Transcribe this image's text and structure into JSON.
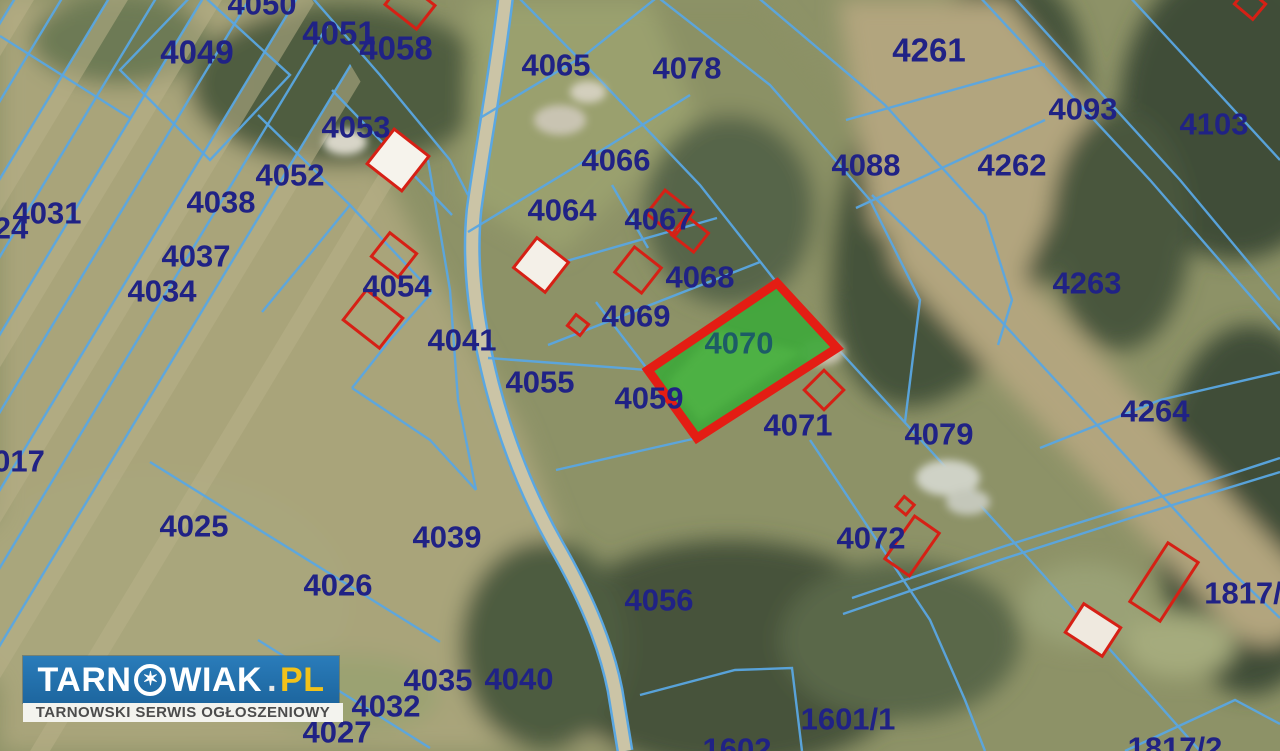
{
  "map": {
    "type": "cadastral-aerial",
    "highlighted_parcel": "4070",
    "highlight_fill": "#3fa83b",
    "highlight_border": "#e41d14",
    "boundary_color": "#5aa7e2",
    "label_color": "#202285",
    "highlight_label_color": "#1d5c66",
    "building_outline_color": "#d62015",
    "parcel_labels": [
      {
        "text": "4050",
        "x": 262,
        "y": 4
      },
      {
        "text": "4049",
        "x": 197,
        "y": 52,
        "size": 33
      },
      {
        "text": "4051",
        "x": 339,
        "y": 33,
        "size": 33
      },
      {
        "text": "4058",
        "x": 396,
        "y": 48,
        "size": 33
      },
      {
        "text": "4053",
        "x": 356,
        "y": 127
      },
      {
        "text": "4052",
        "x": 290,
        "y": 175
      },
      {
        "text": "4038",
        "x": 221,
        "y": 202
      },
      {
        "text": "4031",
        "x": 47,
        "y": 213
      },
      {
        "text": "24",
        "x": 11,
        "y": 228
      },
      {
        "text": "4037",
        "x": 196,
        "y": 256
      },
      {
        "text": "4034",
        "x": 162,
        "y": 291
      },
      {
        "text": "4054",
        "x": 397,
        "y": 286
      },
      {
        "text": "017",
        "x": 19,
        "y": 461
      },
      {
        "text": "4025",
        "x": 194,
        "y": 526
      },
      {
        "text": "4026",
        "x": 338,
        "y": 585
      },
      {
        "text": "4065",
        "x": 556,
        "y": 65
      },
      {
        "text": "4078",
        "x": 687,
        "y": 68
      },
      {
        "text": "4066",
        "x": 616,
        "y": 160
      },
      {
        "text": "4064",
        "x": 562,
        "y": 210
      },
      {
        "text": "4067",
        "x": 659,
        "y": 219
      },
      {
        "text": "4068",
        "x": 700,
        "y": 277
      },
      {
        "text": "4069",
        "x": 636,
        "y": 316
      },
      {
        "text": "4041",
        "x": 462,
        "y": 340
      },
      {
        "text": "4055",
        "x": 540,
        "y": 382
      },
      {
        "text": "4059",
        "x": 649,
        "y": 398
      },
      {
        "text": "4070",
        "x": 739,
        "y": 343,
        "color": "#1d5c66"
      },
      {
        "text": "4071",
        "x": 798,
        "y": 425
      },
      {
        "text": "4079",
        "x": 939,
        "y": 434
      },
      {
        "text": "4072",
        "x": 871,
        "y": 538
      },
      {
        "text": "4039",
        "x": 447,
        "y": 537
      },
      {
        "text": "4056",
        "x": 659,
        "y": 600
      },
      {
        "text": "4035",
        "x": 438,
        "y": 680
      },
      {
        "text": "4040",
        "x": 519,
        "y": 679
      },
      {
        "text": "4032",
        "x": 386,
        "y": 706
      },
      {
        "text": "4027",
        "x": 337,
        "y": 732
      },
      {
        "text": "1601/1",
        "x": 848,
        "y": 719
      },
      {
        "text": "1602",
        "x": 737,
        "y": 749
      },
      {
        "text": "4261",
        "x": 929,
        "y": 50,
        "size": 33
      },
      {
        "text": "4093",
        "x": 1083,
        "y": 109
      },
      {
        "text": "4103",
        "x": 1214,
        "y": 124
      },
      {
        "text": "4088",
        "x": 866,
        "y": 165
      },
      {
        "text": "4262",
        "x": 1012,
        "y": 165
      },
      {
        "text": "4263",
        "x": 1087,
        "y": 283
      },
      {
        "text": "4264",
        "x": 1155,
        "y": 411
      },
      {
        "text": "1817/",
        "x": 1243,
        "y": 593
      },
      {
        "text": "1817/2",
        "x": 1175,
        "y": 748
      }
    ]
  },
  "watermark": {
    "brand_part1": "TARN",
    "brand_part2": "WIAK",
    "brand_dot": ".",
    "brand_tld": "PL",
    "star_char": "✶",
    "tagline": "TARNOWSKI SERWIS OGŁOSZENIOWY",
    "bar_color": "#1f6fb0",
    "tld_color": "#f2c21a"
  }
}
